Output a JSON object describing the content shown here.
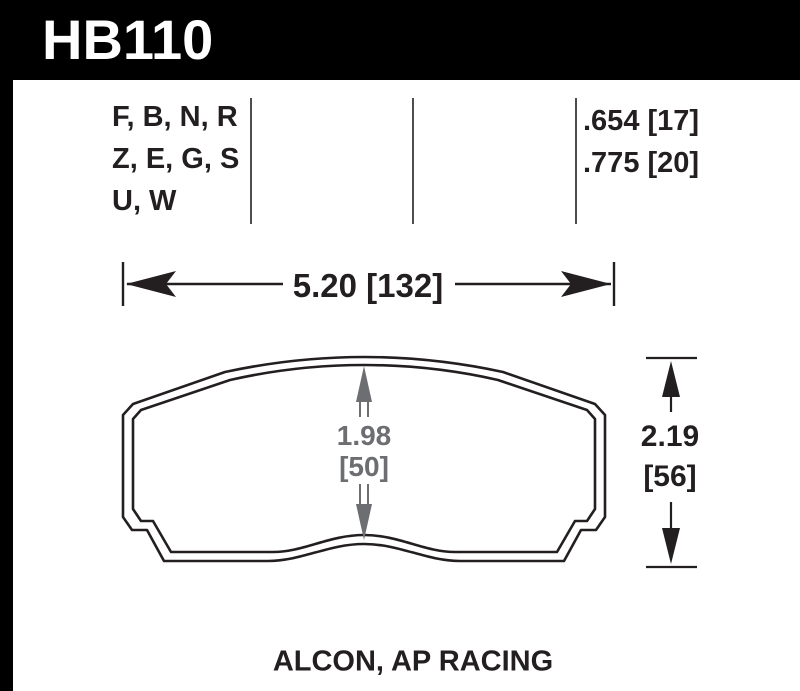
{
  "header": {
    "part_number": "HB110",
    "bg_color": "#000000",
    "text_color": "#ffffff"
  },
  "compound_table": {
    "codes": [
      "F, B, N, R",
      "Z, E, G, S",
      "U, W"
    ],
    "thickness_values": [
      ".654 [17]",
      ".775 [20]"
    ]
  },
  "dimensions": {
    "width_label": "5.20 [132]",
    "overall_height_in": "2.19",
    "overall_height_mm": "[56]",
    "center_height_in": "1.98",
    "center_height_mm": "[50]"
  },
  "footer": {
    "caliper_applications": "ALCON, AP RACING"
  },
  "colors": {
    "outline": "#231f20",
    "dimension_gray": "#6d6e71",
    "divider_gray": "#4d4d4d"
  }
}
